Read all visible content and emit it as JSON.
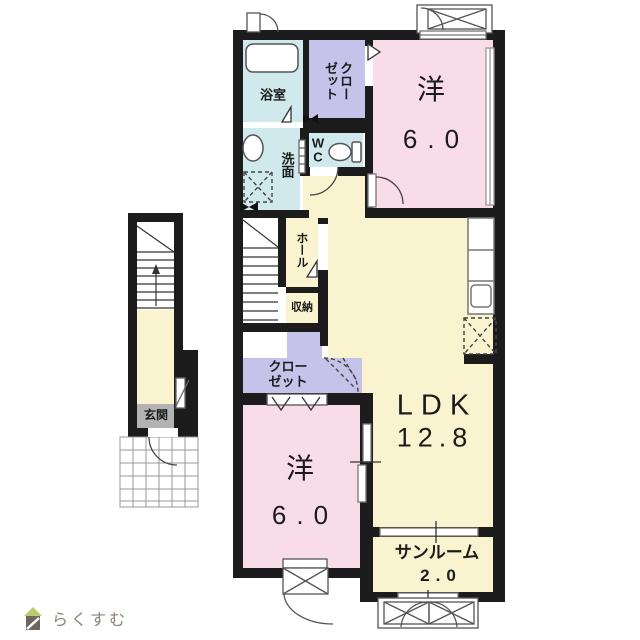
{
  "floorplan": {
    "labels": {
      "bathroom": "浴室",
      "closet_top_line1": "クロー",
      "closet_top_line2": "ゼット",
      "wc": "WC",
      "washroom": "洗面",
      "bedroom_top_name": "洋",
      "bedroom_top_size": "6.0",
      "hall": "ホール",
      "storage": "収納",
      "closet_mid_line1": "クロー",
      "closet_mid_line2": "ゼット",
      "ldk_name": "LDK",
      "ldk_size": "12.8",
      "bedroom_bottom_name": "洋",
      "bedroom_bottom_size": "6.0",
      "sunroom_name": "サンルーム",
      "sunroom_size": "2.0",
      "entrance": "玄関"
    },
    "colors": {
      "wall": "#1c1c1c",
      "room_pink": "#f8dce8",
      "room_yellow": "#faf3cf",
      "room_blue": "#cfe9ec",
      "closet_purple": "#c6c3ea",
      "entrance_gray": "#b3b3b3",
      "floor_white": "#ffffff"
    }
  },
  "logo": {
    "text": "らくすむ",
    "roof_color": "#b9cb6f",
    "body_color": "#6e675e",
    "text_color": "#8e8377"
  }
}
